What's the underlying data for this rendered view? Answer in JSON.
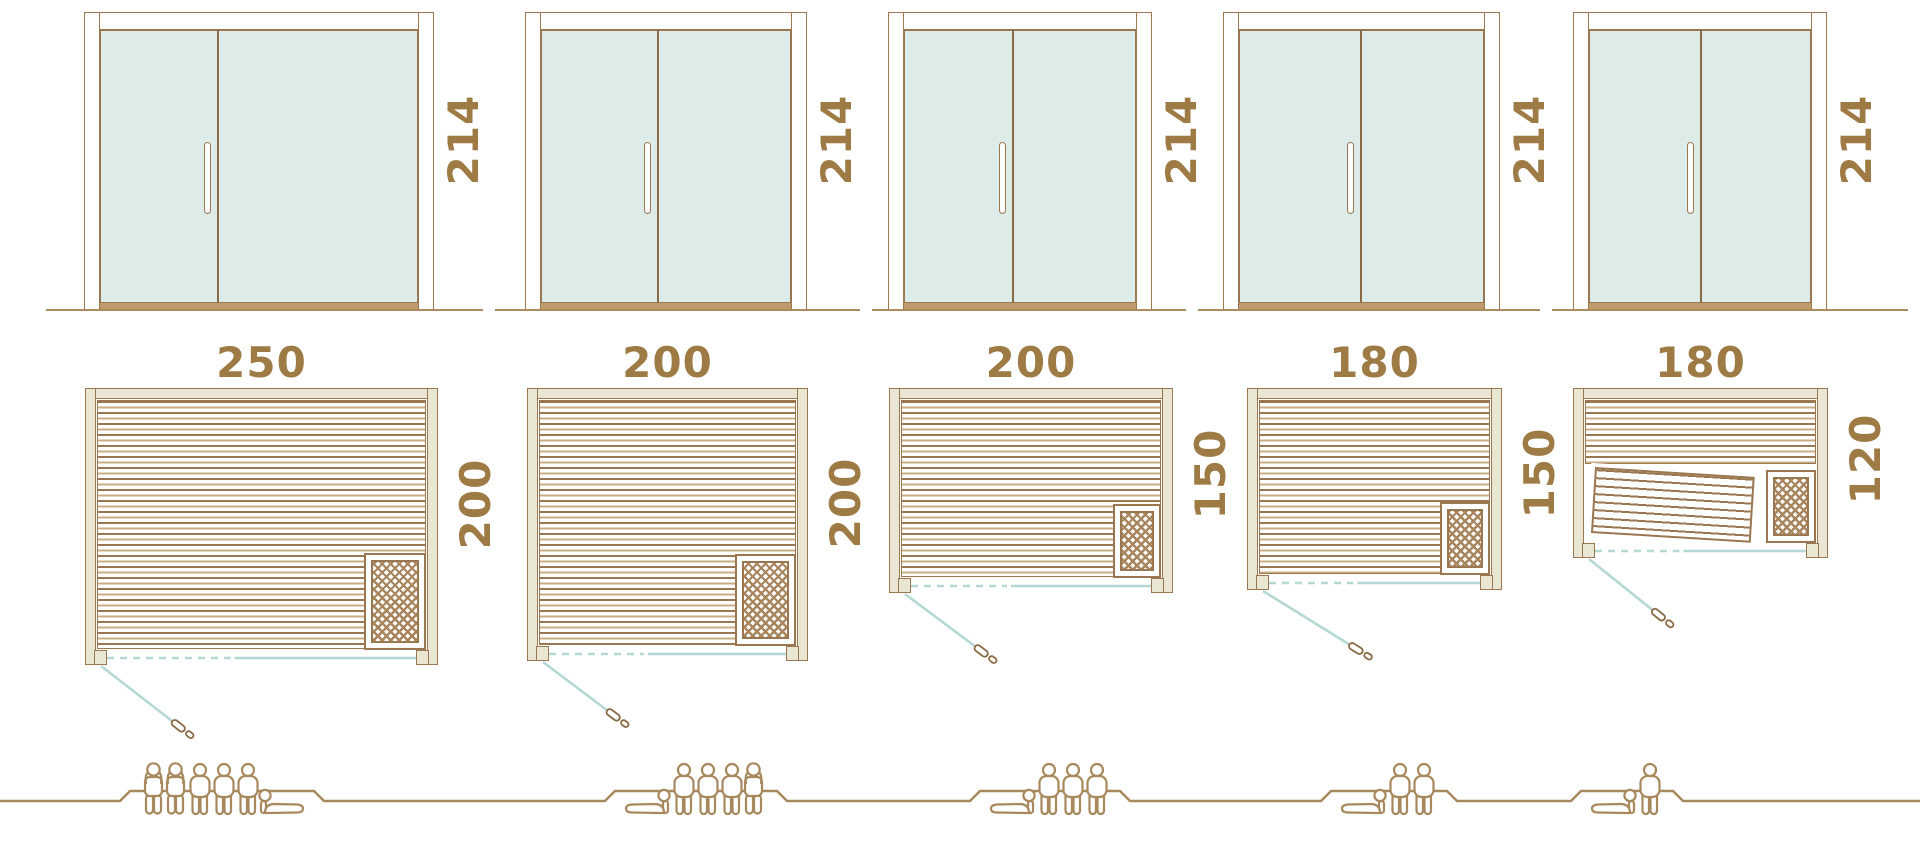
{
  "diagram": {
    "kind": "sauna-cabin-size-comparison",
    "rows": [
      "door-front-elevations",
      "floor-plans",
      "capacity-figures"
    ]
  },
  "palette": {
    "outline_brown": "#9a7750",
    "dark_brown": "#8a6a45",
    "dimension_text_gold": "#9e7a45",
    "wall_cream": "#e9e6d3",
    "glass_teal_fill": "#ddece9",
    "door_swing_teal": "#b5d8d4",
    "figure_brown": "#a8895e",
    "sill_tan": "#c09b6d"
  },
  "units": [
    {
      "height_label": "214",
      "width_label": "250",
      "depth_label": "200",
      "capacity_total": 6,
      "figures": [
        "standing",
        "standing",
        "sitting",
        "sitting",
        "sitting",
        "lying"
      ]
    },
    {
      "height_label": "214",
      "width_label": "200",
      "depth_label": "200",
      "capacity_total": 5,
      "figures": [
        "lying",
        "sitting",
        "sitting",
        "sitting",
        "standing"
      ]
    },
    {
      "height_label": "214",
      "width_label": "200",
      "depth_label": "150",
      "capacity_total": 4,
      "figures": [
        "lying",
        "sitting",
        "sitting",
        "sitting"
      ]
    },
    {
      "height_label": "214",
      "width_label": "180",
      "depth_label": "150",
      "capacity_total": 3,
      "figures": [
        "lying",
        "sitting",
        "sitting"
      ]
    },
    {
      "height_label": "214",
      "width_label": "180",
      "depth_label": "120",
      "capacity_total": 2,
      "figures": [
        "lying",
        "sitting"
      ]
    }
  ]
}
